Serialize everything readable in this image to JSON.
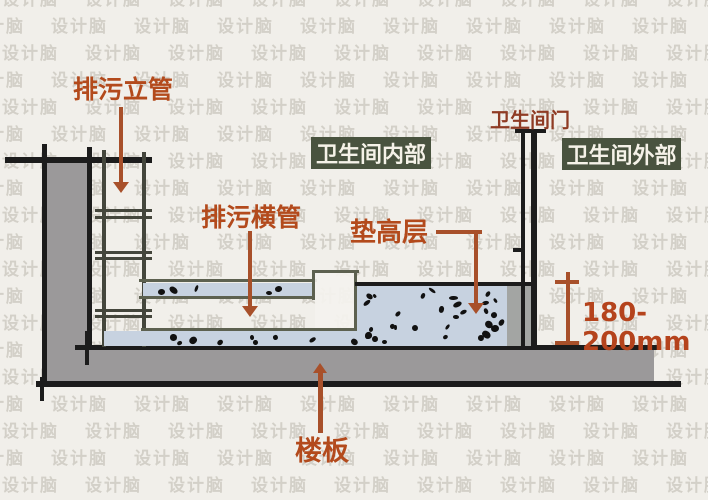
{
  "watermark": {
    "text": "设计脑"
  },
  "labels": {
    "vertical_pipe": "排污立管",
    "horizontal_pipe": "排污横管",
    "raised_layer": "垫高层",
    "floor_slab": "楼板",
    "bathroom_door": "卫生间门",
    "bathroom_inside": "卫生间内部",
    "bathroom_outside": "卫生间外部",
    "height_dimension": "180-200mm"
  },
  "colors": {
    "label-orange": "#b34a1c",
    "door-label-color": "#8f3b24",
    "dimension-red": "#b5431c",
    "arrow-color": "#a8502a",
    "green-box-bg": "#49533f",
    "green-box-text": "#f5f2e8",
    "wall-gray": "#9b999a",
    "concrete-fill": "#c7d2e0",
    "line-black": "#1c1c1c",
    "pipe-olive": "#44463c",
    "strip-border": "#5d6150"
  }
}
